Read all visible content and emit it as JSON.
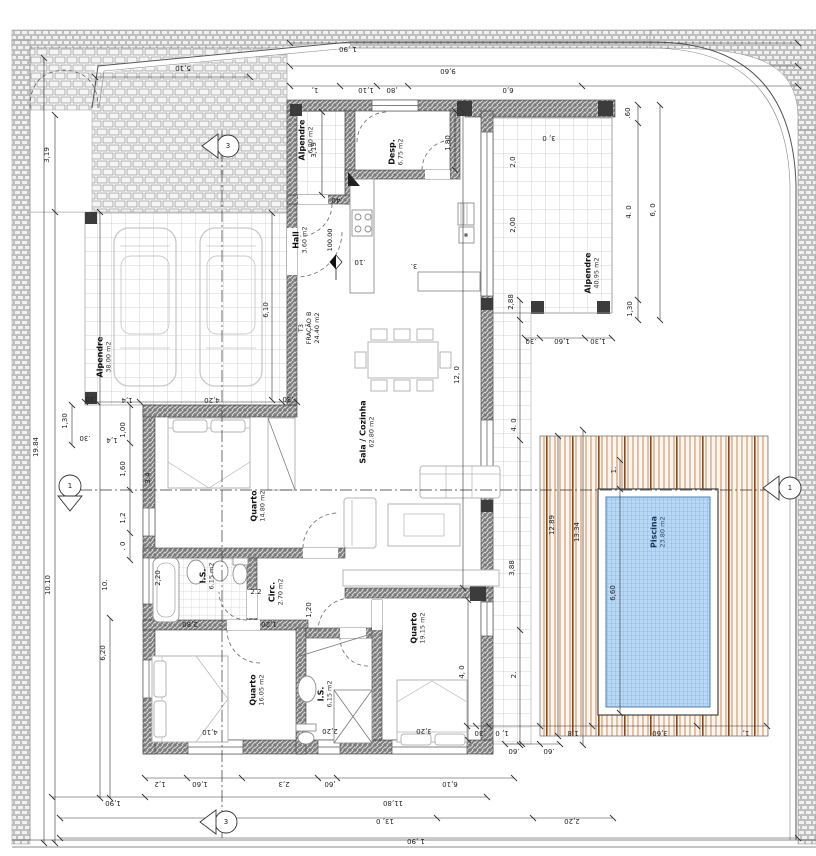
{
  "rooms": {
    "carport": {
      "name": "Alpendre",
      "area": "38.00 m2"
    },
    "entry_porch": {
      "name": "Alpendre",
      "area": "6.80 m2"
    },
    "hall": {
      "name": "Hall",
      "area": "3.60 m2"
    },
    "desp": {
      "name": "Desp.",
      "area": "6.75 m2"
    },
    "sala_cozinha": {
      "name": "Sala / Cozinha",
      "area": "62.80 m2"
    },
    "quarto1": {
      "name": "Quarto",
      "area": "14.80 m2"
    },
    "is1": {
      "name": "I.S.",
      "area": "6.15 m2"
    },
    "circ": {
      "name": "Circ.",
      "area": "2.70 m2"
    },
    "quarto2": {
      "name": "Quarto",
      "area": "16.05 m2"
    },
    "is2": {
      "name": "I.S.",
      "area": "6,15 m2"
    },
    "quarto3": {
      "name": "Quarto",
      "area": "19.15 m2"
    },
    "east_porch": {
      "name": "Alpendre",
      "area": "40.95 m2"
    },
    "piscina": {
      "name": "Piscina",
      "area": "23.80 m2"
    }
  },
  "fraction": {
    "line1": "T3",
    "line2": "FRAÇÃO B",
    "area": "24.40 m2"
  },
  "level_marker": "100.00",
  "section_markers": {
    "top": "3",
    "bottom": "3",
    "left": "1",
    "right": "1"
  },
  "dim_labels": [
    {
      "t": "5,10",
      "x": 183,
      "y": 68,
      "r": 180
    },
    {
      "t": "1 ,90",
      "x": 348,
      "y": 49,
      "r": 180
    },
    {
      "t": "9,60",
      "x": 448,
      "y": 71,
      "r": 180
    },
    {
      "t": "1,",
      "x": 315,
      "y": 90,
      "r": 180
    },
    {
      "t": "1,10",
      "x": 366,
      "y": 90,
      "r": 180
    },
    {
      "t": ",80",
      "x": 392,
      "y": 90,
      "r": 180
    },
    {
      "t": "6,0",
      "x": 508,
      "y": 90,
      "r": 180
    },
    {
      "t": ".60",
      "x": 628,
      "y": 113,
      "r": -90
    },
    {
      "t": "3, 0",
      "x": 549,
      "y": 138,
      "r": 180
    },
    {
      "t": "1,80",
      "x": 448,
      "y": 143,
      "r": -90
    },
    {
      "t": "2,0",
      "x": 513,
      "y": 162,
      "r": -90
    },
    {
      "t": "2,00",
      "x": 513,
      "y": 225,
      "r": -90
    },
    {
      "t": "6, 0",
      "x": 653,
      "y": 210,
      "r": -90
    },
    {
      "t": "4. 0",
      "x": 629,
      "y": 212,
      "r": -90
    },
    {
      "t": "2,88",
      "x": 511,
      "y": 302,
      "r": -90
    },
    {
      "t": "1,30",
      "x": 630,
      "y": 309,
      "r": -90
    },
    {
      "t": ".30",
      "x": 531,
      "y": 341,
      "r": 180
    },
    {
      "t": "1,60",
      "x": 562,
      "y": 341,
      "r": 180
    },
    {
      "t": "1,30",
      "x": 598,
      "y": 341,
      "r": 180
    },
    {
      "t": "3,19",
      "x": 314,
      "y": 150,
      "r": -90
    },
    {
      "t": ".40",
      "x": 337,
      "y": 200,
      "r": 180
    },
    {
      "t": ".10",
      "x": 360,
      "y": 262,
      "r": 180
    },
    {
      "t": "3.",
      "x": 414,
      "y": 266,
      "r": 180
    },
    {
      "t": "3,19",
      "x": 47,
      "y": 155,
      "r": -90
    },
    {
      "t": "19.84",
      "x": 36,
      "y": 447,
      "r": -90
    },
    {
      "t": "10.10",
      "x": 48,
      "y": 585,
      "r": -90
    },
    {
      "t": "10.",
      "x": 105,
      "y": 585,
      "r": -90
    },
    {
      "t": "6,20",
      "x": 103,
      "y": 653,
      "r": -90
    },
    {
      "t": "1,30",
      "x": 65,
      "y": 421,
      "r": -90
    },
    {
      "t": "1,00",
      "x": 123,
      "y": 430,
      "r": -90
    },
    {
      "t": "1,4",
      "x": 112,
      "y": 440,
      "r": 180
    },
    {
      "t": ".30",
      "x": 85,
      "y": 438,
      "r": 180
    },
    {
      "t": "1,60",
      "x": 123,
      "y": 469,
      "r": -90
    },
    {
      "t": "1,2",
      "x": 123,
      "y": 518,
      "r": -90
    },
    {
      "t": ". 0",
      "x": 123,
      "y": 546,
      "r": -90
    },
    {
      "t": ".30",
      "x": 91,
      "y": 399,
      "r": 180
    },
    {
      "t": "1,4",
      "x": 127,
      "y": 400,
      "r": 180
    },
    {
      "t": "4,20",
      "x": 212,
      "y": 400,
      "r": 180
    },
    {
      "t": ".30",
      "x": 288,
      "y": 399,
      "r": 180
    },
    {
      "t": "6,10",
      "x": 266,
      "y": 310,
      "r": -90
    },
    {
      "t": "3.4",
      "x": 148,
      "y": 478,
      "r": -90
    },
    {
      "t": "2,20",
      "x": 158,
      "y": 578,
      "r": -90
    },
    {
      "t": "2.2",
      "x": 256,
      "y": 592,
      "r": 0
    },
    {
      "t": "2,80",
      "x": 190,
      "y": 624,
      "r": 180
    },
    {
      "t": "1,20",
      "x": 269,
      "y": 624,
      "r": 180
    },
    {
      "t": "12, 0",
      "x": 457,
      "y": 375,
      "r": -90
    },
    {
      "t": "4, 0",
      "x": 462,
      "y": 672,
      "r": -90
    },
    {
      "t": "1,20",
      "x": 309,
      "y": 610,
      "r": -90
    },
    {
      "t": "4,10",
      "x": 210,
      "y": 732,
      "r": 180
    },
    {
      "t": "2,20",
      "x": 330,
      "y": 731,
      "r": 180
    },
    {
      "t": "3,20",
      "x": 424,
      "y": 731,
      "r": 180
    },
    {
      "t": "4. 0",
      "x": 514,
      "y": 425,
      "r": -90
    },
    {
      "t": "3,88",
      "x": 512,
      "y": 568,
      "r": -90
    },
    {
      "t": "2.",
      "x": 514,
      "y": 675,
      "r": -90
    },
    {
      "t": "1.",
      "x": 614,
      "y": 470,
      "r": -90
    },
    {
      "t": "12.89",
      "x": 552,
      "y": 525,
      "r": -90
    },
    {
      "t": "13.34",
      "x": 577,
      "y": 532,
      "r": -90
    },
    {
      "t": "6,60",
      "x": 613,
      "y": 593,
      "r": -90
    },
    {
      "t": ".30",
      "x": 480,
      "y": 733,
      "r": 180
    },
    {
      "t": "1, 0",
      "x": 502,
      "y": 733,
      "r": 180
    },
    {
      "t": "1,8",
      "x": 573,
      "y": 733,
      "r": 180
    },
    {
      "t": "3,60",
      "x": 660,
      "y": 733,
      "r": 180
    },
    {
      "t": "1,",
      "x": 746,
      "y": 733,
      "r": 180
    },
    {
      "t": ".60",
      "x": 514,
      "y": 751,
      "r": 180
    },
    {
      "t": ".60",
      "x": 549,
      "y": 751,
      "r": 180
    },
    {
      "t": "1,2",
      "x": 160,
      "y": 784,
      "r": 180
    },
    {
      "t": "1,60",
      "x": 200,
      "y": 784,
      "r": 180
    },
    {
      "t": "2,3",
      "x": 284,
      "y": 784,
      "r": 180
    },
    {
      "t": ",60",
      "x": 330,
      "y": 784,
      "r": 180
    },
    {
      "t": "6,10",
      "x": 450,
      "y": 784,
      "r": 180
    },
    {
      "t": "1,90",
      "x": 113,
      "y": 803,
      "r": 180
    },
    {
      "t": "11,80",
      "x": 393,
      "y": 803,
      "r": 180
    },
    {
      "t": "13, 0",
      "x": 385,
      "y": 821,
      "r": 180
    },
    {
      "t": "2,20",
      "x": 572,
      "y": 821,
      "r": 180
    },
    {
      "t": "1 ,90",
      "x": 416,
      "y": 841,
      "r": 180
    }
  ]
}
